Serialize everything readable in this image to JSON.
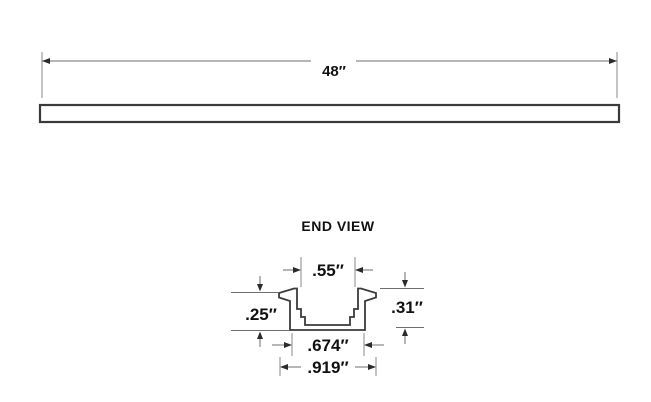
{
  "top_view": {
    "length_label": "48″"
  },
  "end_view": {
    "title": "END VIEW",
    "opening_width": ".55″",
    "left_height": ".25″",
    "right_height": ".31″",
    "inner_width": ".674″",
    "overall_width": ".919″"
  },
  "colors": {
    "ink": "#111111",
    "profile_stroke": "#3a3a3a",
    "dimension_line": "#6e6e6e",
    "background": "#ffffff"
  }
}
